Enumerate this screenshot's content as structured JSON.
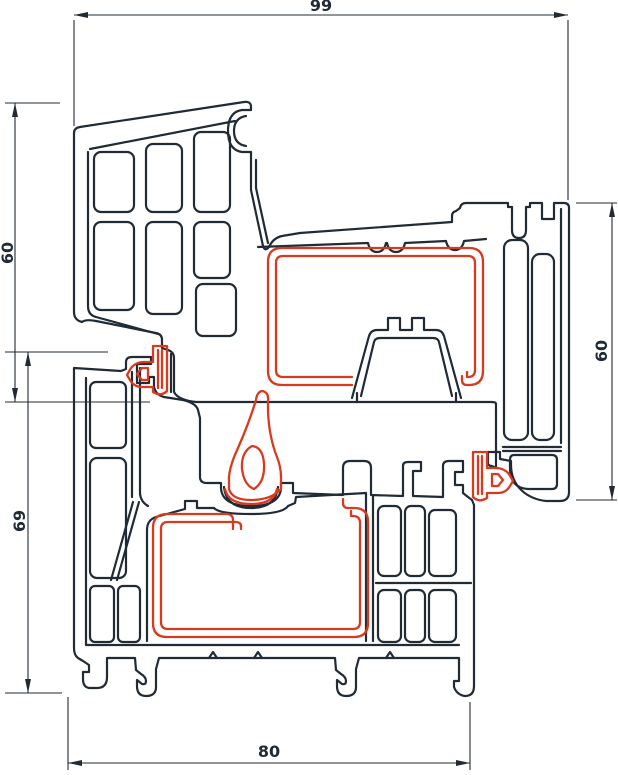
{
  "drawing": {
    "type": "window-profile-cross-section",
    "background": "#ffffff",
    "outline_color": "#202b36",
    "gasket_color": "#d83a20",
    "dimensions": {
      "top": {
        "value": "99"
      },
      "left_upper": {
        "value": "60"
      },
      "left_lower": {
        "value": "69"
      },
      "right": {
        "value": "60"
      },
      "bottom": {
        "value": "80"
      }
    }
  }
}
